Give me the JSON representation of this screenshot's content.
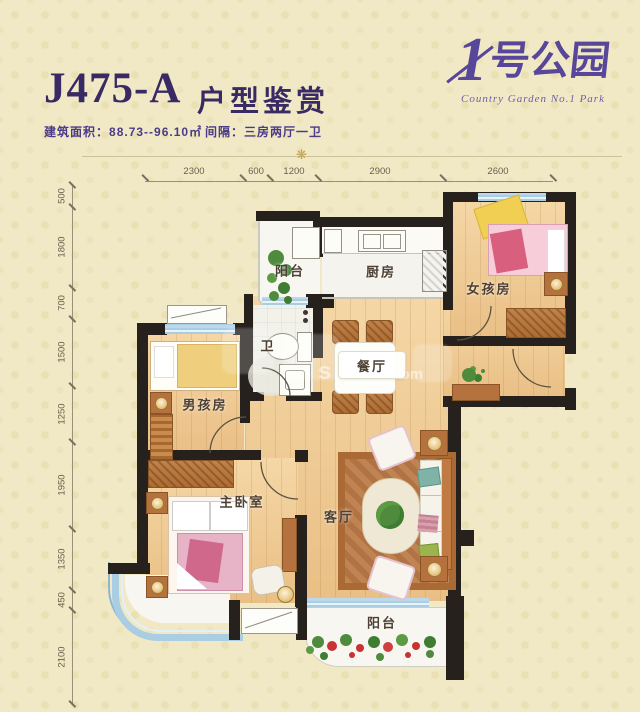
{
  "header": {
    "unit_code": "J475-A",
    "title_suffix": "户型鉴赏",
    "area_label": "建筑面积：",
    "area_value": "88.73--96.10㎡",
    "layout_label": "间隔：",
    "layout_value": "三房两厅一卫",
    "ornament": "❋"
  },
  "logo": {
    "brand_number": "1",
    "brand_name": "号公园",
    "subtitle": "Country Garden No.1 Park"
  },
  "dimensions": {
    "top": [
      "2300",
      "600",
      "1200",
      "2900",
      "2600"
    ],
    "left": [
      "500",
      "1800",
      "700",
      "1500",
      "1250",
      "1950",
      "1350",
      "450",
      "2100"
    ]
  },
  "rooms": {
    "balcony_top": "阳台",
    "kitchen": "厨房",
    "girl_room": "女孩房",
    "bathroom": "卫",
    "dining_room": "餐厅",
    "boy_room": "男孩房",
    "master_bedroom": "主卧室",
    "living_room": "客厅",
    "balcony_bottom": "阳台"
  },
  "watermark": {
    "letter": "s",
    "domain_suffix": ".com"
  },
  "colors": {
    "accent_purple": "#574699",
    "wall_black": "#26211d",
    "window_blue": "#a9cde3",
    "wood_floor": "#eec795",
    "flower_red": "#c83232",
    "leaf_green": "#4e8b3d"
  }
}
